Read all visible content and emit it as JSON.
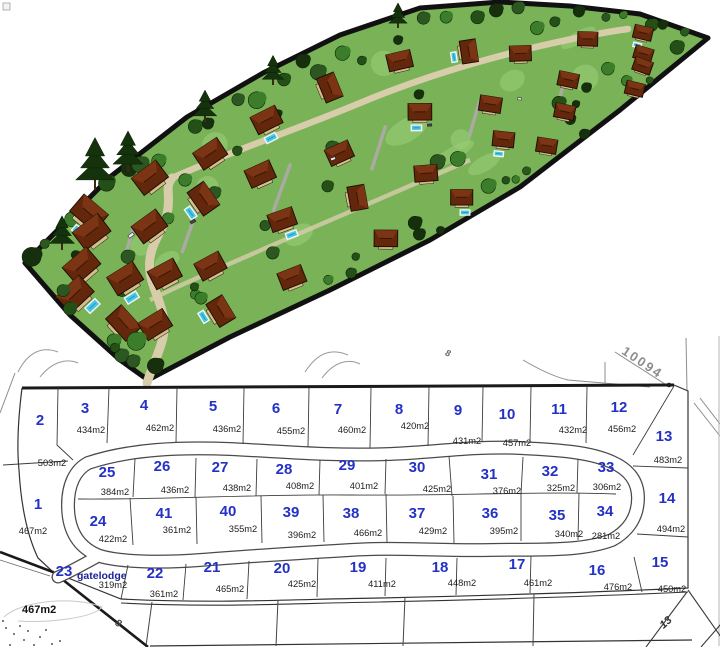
{
  "colors": {
    "plot_number": "#2431c6",
    "gatelodge_text": "#1b2496",
    "area_text": "#1c1c1c",
    "plan_line": "#333333",
    "lawn": "#79b257",
    "lawn_light": "#9ccf79",
    "tree_dark": "#16300e",
    "tree_mid": "#2c5720",
    "tree_light": "#3b7d2a",
    "roof_base": "#63270b",
    "roof_light": "#7c3514",
    "pool": "#45c6e6",
    "road_3d": "#d8cdab",
    "driveway": "#aaaaa2",
    "survey_line": "#8c8c8c"
  },
  "plan": {
    "plots": [
      {
        "no": "2",
        "area": "503m2",
        "nx": 40,
        "ny": 425,
        "ax": 52,
        "ay": 466
      },
      {
        "no": "3",
        "area": "434m2",
        "nx": 85,
        "ny": 413,
        "ax": 91,
        "ay": 433
      },
      {
        "no": "4",
        "area": "462m2",
        "nx": 144,
        "ny": 410,
        "ax": 160,
        "ay": 431
      },
      {
        "no": "5",
        "area": "436m2",
        "nx": 213,
        "ny": 411,
        "ax": 227,
        "ay": 432
      },
      {
        "no": "6",
        "area": "455m2",
        "nx": 276,
        "ny": 413,
        "ax": 291,
        "ay": 434
      },
      {
        "no": "7",
        "area": "460m2",
        "nx": 338,
        "ny": 414,
        "ax": 352,
        "ay": 433
      },
      {
        "no": "8",
        "area": "420m2",
        "nx": 399,
        "ny": 414,
        "ax": 415,
        "ay": 429
      },
      {
        "no": "9",
        "area": "431m2",
        "nx": 458,
        "ny": 415,
        "ax": 467,
        "ay": 444
      },
      {
        "no": "10",
        "area": "457m2",
        "nx": 507,
        "ny": 419,
        "ax": 517,
        "ay": 446
      },
      {
        "no": "11",
        "area": "432m2",
        "nx": 559,
        "ny": 414,
        "ax": 573,
        "ay": 433
      },
      {
        "no": "12",
        "area": "456m2",
        "nx": 619,
        "ny": 412,
        "ax": 622,
        "ay": 432
      },
      {
        "no": "13",
        "area": "483m2",
        "nx": 664,
        "ny": 441,
        "ax": 668,
        "ay": 463
      },
      {
        "no": "14",
        "area": "494m2",
        "nx": 667,
        "ny": 503,
        "ax": 671,
        "ay": 532
      },
      {
        "no": "15",
        "area": "450m2",
        "nx": 660,
        "ny": 567,
        "ax": 672,
        "ay": 592
      },
      {
        "no": "16",
        "area": "476m2",
        "nx": 597,
        "ny": 575,
        "ax": 618,
        "ay": 590
      },
      {
        "no": "17",
        "area": "461m2",
        "nx": 517,
        "ny": 569,
        "ax": 538,
        "ay": 586
      },
      {
        "no": "18",
        "area": "448m2",
        "nx": 440,
        "ny": 572,
        "ax": 462,
        "ay": 586
      },
      {
        "no": "19",
        "area": "411m2",
        "nx": 358,
        "ny": 572,
        "ax": 382,
        "ay": 587
      },
      {
        "no": "20",
        "area": "425m2",
        "nx": 282,
        "ny": 573,
        "ax": 302,
        "ay": 587
      },
      {
        "no": "21",
        "area": "465m2",
        "nx": 212,
        "ny": 572,
        "ax": 230,
        "ay": 592
      },
      {
        "no": "22",
        "area": "361m2",
        "nx": 155,
        "ny": 578,
        "ax": 164,
        "ay": 597
      },
      {
        "no": "24",
        "area": "422m2",
        "nx": 98,
        "ny": 526,
        "ax": 113,
        "ay": 542
      },
      {
        "no": "25",
        "area": "384m2",
        "nx": 107,
        "ny": 477,
        "ax": 115,
        "ay": 495
      },
      {
        "no": "26",
        "area": "436m2",
        "nx": 162,
        "ny": 471,
        "ax": 175,
        "ay": 493
      },
      {
        "no": "27",
        "area": "438m2",
        "nx": 220,
        "ny": 472,
        "ax": 237,
        "ay": 491
      },
      {
        "no": "28",
        "area": "408m2",
        "nx": 284,
        "ny": 474,
        "ax": 300,
        "ay": 489
      },
      {
        "no": "29",
        "area": "401m2",
        "nx": 347,
        "ny": 470,
        "ax": 364,
        "ay": 489
      },
      {
        "no": "30",
        "area": "425m2",
        "nx": 417,
        "ny": 472,
        "ax": 437,
        "ay": 492
      },
      {
        "no": "31",
        "area": "376m2",
        "nx": 489,
        "ny": 479,
        "ax": 507,
        "ay": 494
      },
      {
        "no": "32",
        "area": "325m2",
        "nx": 550,
        "ny": 476,
        "ax": 561,
        "ay": 491
      },
      {
        "no": "33",
        "area": "306m2",
        "nx": 606,
        "ny": 472,
        "ax": 607,
        "ay": 490
      },
      {
        "no": "34",
        "area": "281m2",
        "nx": 605,
        "ny": 516,
        "ax": 606,
        "ay": 539
      },
      {
        "no": "35",
        "area": "340m2",
        "nx": 557,
        "ny": 520,
        "ax": 569,
        "ay": 537
      },
      {
        "no": "36",
        "area": "395m2",
        "nx": 490,
        "ny": 518,
        "ax": 504,
        "ay": 534
      },
      {
        "no": "37",
        "area": "429m2",
        "nx": 417,
        "ny": 518,
        "ax": 433,
        "ay": 534
      },
      {
        "no": "38",
        "area": "466m2",
        "nx": 351,
        "ny": 518,
        "ax": 368,
        "ay": 536
      },
      {
        "no": "39",
        "area": "396m2",
        "nx": 291,
        "ny": 517,
        "ax": 302,
        "ay": 538
      },
      {
        "no": "40",
        "area": "355m2",
        "nx": 228,
        "ny": 516,
        "ax": 243,
        "ay": 532
      },
      {
        "no": "41",
        "area": "361m2",
        "nx": 164,
        "ny": 518,
        "ax": 177,
        "ay": 533
      },
      {
        "no": "1",
        "area": "467m2",
        "nx": 38,
        "ny": 509,
        "ax": 33,
        "ay": 534
      },
      {
        "no": "23",
        "area": "319m2",
        "nx": 64,
        "ny": 576,
        "ax": 113,
        "ay": 588,
        "suffix": "gatelodge",
        "sx": 77,
        "sy": 579
      }
    ],
    "gatelodge_label": "gatelodge"
  },
  "annotations": [
    {
      "text": "10094",
      "x": 640,
      "y": 366,
      "rot": 34,
      "size": 13,
      "color": "#8d8d8d",
      "weight": "bold",
      "style": "normal",
      "ls": 2,
      "anchor": "middle"
    },
    {
      "text": "8",
      "x": 447,
      "y": 356,
      "rot": 20,
      "size": 9,
      "color": "#6a6a6a",
      "weight": "bold",
      "style": "italic",
      "ls": 0,
      "anchor": "middle"
    },
    {
      "text": "467m2",
      "x": 22,
      "y": 613,
      "rot": 0,
      "size": 11,
      "color": "#111111",
      "weight": "bold",
      "style": "normal",
      "ls": 0,
      "anchor": "start"
    },
    {
      "text": "8",
      "x": 117,
      "y": 626,
      "rot": 28,
      "size": 10,
      "color": "#4a4a4a",
      "weight": "bold",
      "style": "italic",
      "ls": 0,
      "anchor": "middle"
    },
    {
      "text": "13",
      "x": 668,
      "y": 625,
      "rot": -42,
      "size": 11,
      "color": "#333333",
      "weight": "bold",
      "style": "italic",
      "ls": 0,
      "anchor": "middle"
    }
  ]
}
